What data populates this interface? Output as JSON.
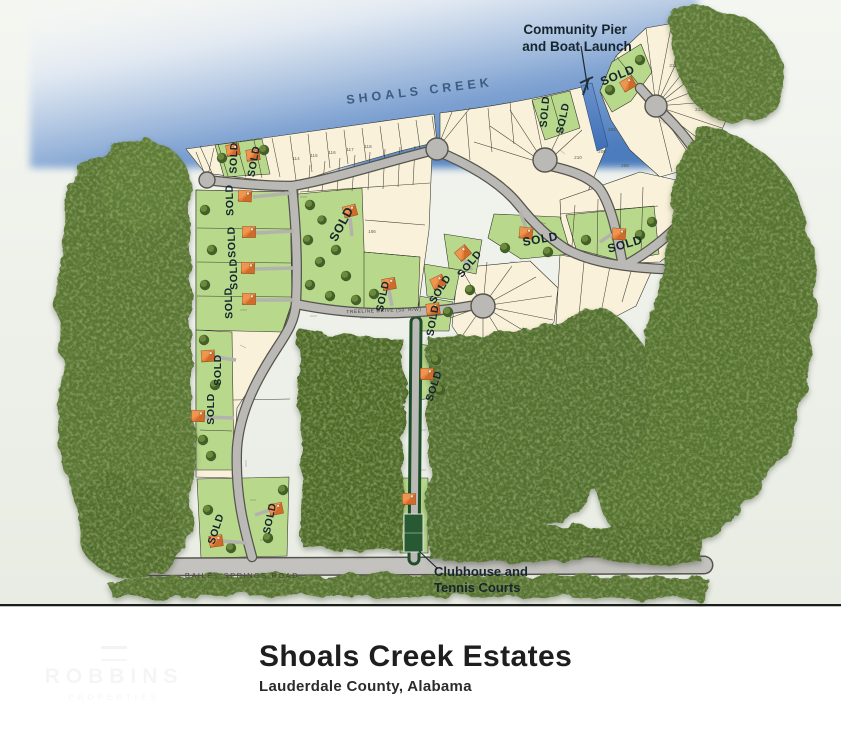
{
  "title_block": {
    "title": "Shoals Creek Estates",
    "subtitle": "Lauderdale County, Alabama"
  },
  "map": {
    "creek_label": "SHOALS CREEK",
    "pier_label": {
      "line1": "Community Pier",
      "line2": "and Boat Launch"
    },
    "clubhouse_label": {
      "line1": "Clubhouse and",
      "line2": "Tennis Courts"
    },
    "bailey_road_label": "BAILEY SPRINGS ROAD",
    "treeline_road_label": "TREELINE  DRIVE  (50' R/W)",
    "sold_label": "SOLD",
    "lot_numbers": [
      "114",
      "115",
      "116",
      "117",
      "118",
      "204",
      "206",
      "208",
      "210",
      "211",
      "212",
      "213",
      "216",
      "156"
    ],
    "colors": {
      "water": "#5c88c8",
      "lot_cream": "#f9f1d9",
      "lot_sold_green": "#b8d88c",
      "road": "#bab9b5",
      "forest": "#55702d",
      "house_orange": "#e8823b",
      "sold_text": "#15242d"
    }
  },
  "watermark": {
    "line1": "ROBBINS",
    "line2": "PROPERTIES"
  }
}
